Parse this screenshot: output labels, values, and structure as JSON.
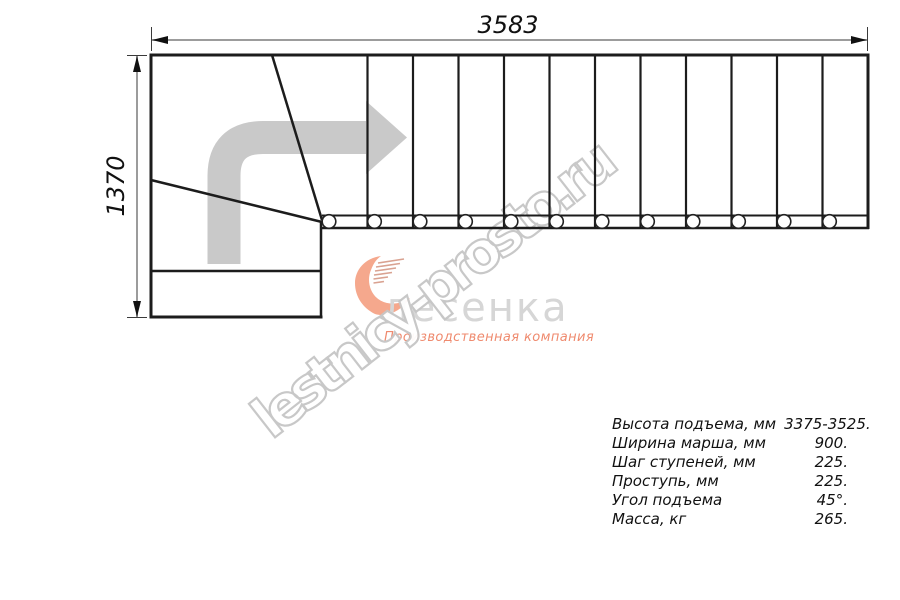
{
  "dimensions": {
    "total_length_mm": "3583",
    "total_width_mm": "1370"
  },
  "watermark": {
    "text": "lestnicy-prosto.ru"
  },
  "logo": {
    "name": "лесенка",
    "tagline": "Производственная компания"
  },
  "specs": {
    "rows": [
      {
        "label": "Высота подъема, мм",
        "value": "3375-3525."
      },
      {
        "label": "Ширина марша, мм",
        "value": "900."
      },
      {
        "label": "Шаг ступеней, мм",
        "value": "225."
      },
      {
        "label": "Проступь, мм",
        "value": "225."
      },
      {
        "label": "Угол подъема",
        "value": "45°."
      },
      {
        "label": "Масса, кг",
        "value": "265."
      }
    ]
  },
  "colors": {
    "line": "#1c1c1c",
    "dimension": "#9c9c9c",
    "arrow": "#c9c9c9",
    "logo_text": "#d6d6d6",
    "logo_accent": "#ef8a6e",
    "watermark": "#c6c6c6"
  }
}
